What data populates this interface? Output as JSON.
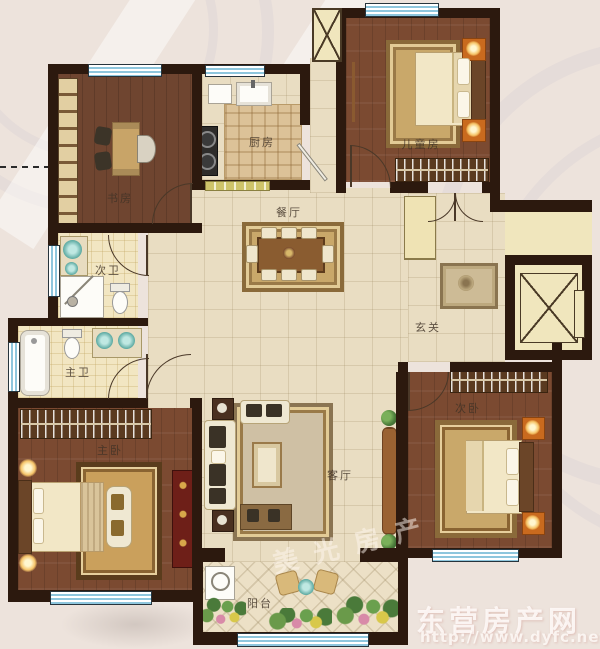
{
  "plan": {
    "rooms": {
      "study": "书房",
      "kitchen": "厨房",
      "kids_room": "儿童房",
      "dining": "餐厅",
      "guest_bath": "次卫",
      "master_bath": "主卫",
      "master_bed": "主卧",
      "living": "客厅",
      "second_bed": "次卧",
      "balcony": "阳台",
      "entry": "玄关"
    },
    "watermark": {
      "diagonal": "美光房产",
      "site_name": "东营房产网",
      "site_url": "http://www.dyfc.net"
    },
    "colors": {
      "wall": "#2c190e",
      "wood_floor": "#7b4a31",
      "hall_tile": "#e9ddc2",
      "bath_tile": "#f2e6c2",
      "window_blue": "#8ec6dd",
      "accent_orange": "#c96a1e",
      "rug_gold": "#c9a86a"
    }
  }
}
